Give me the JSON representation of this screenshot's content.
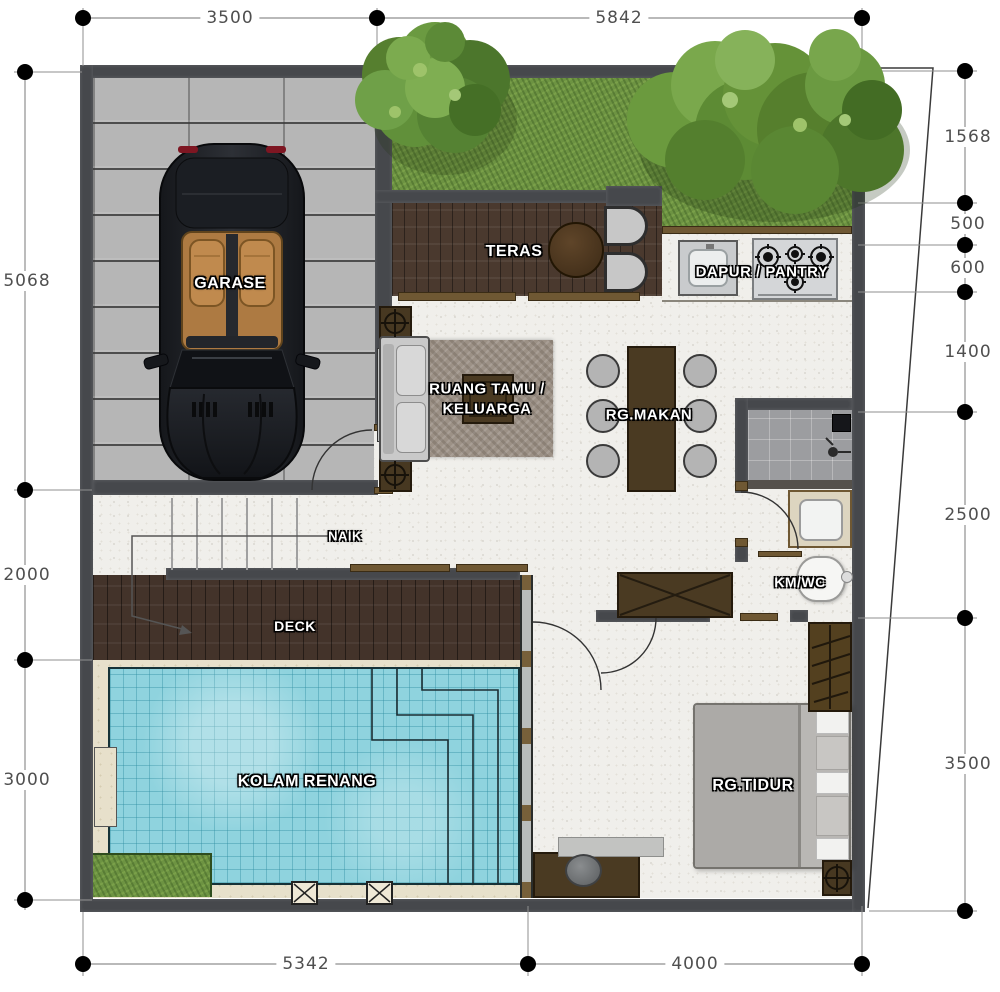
{
  "dimensions": {
    "top": [
      "3500",
      "5842"
    ],
    "right": [
      "1568",
      "500",
      "600",
      "1400",
      "2500",
      "3500"
    ],
    "left": [
      "5068",
      "2000",
      "3000"
    ],
    "bottom": [
      "5342",
      "4000"
    ]
  },
  "rooms": {
    "garase": "GARASE",
    "teras": "TERAS",
    "dapur": "DAPUR / PANTRY",
    "tamu": "RUANG TAMU / KELUARGA",
    "makan": "RG.MAKAN",
    "naik": "NAIK",
    "deck": "DECK",
    "kmwc": "KM/WC",
    "kolam": "KOLAM RENANG",
    "tidur": "RG.TIDUR"
  },
  "colors": {
    "wall": "#46484c",
    "pool_water": "#8fd3de",
    "grass": "#6d9342",
    "deck_wood": "#43332a",
    "teras_wood": "#4a392e",
    "paving_beige": "#e7e0cb",
    "interior_floor": "#f0efeb",
    "garage_paver": "#b6b6b6",
    "furniture_brown": "#4a3a22",
    "shower_tile": "#9c9da0",
    "label_text": "#ffffff",
    "dimension_text": "#4f4f4f"
  }
}
